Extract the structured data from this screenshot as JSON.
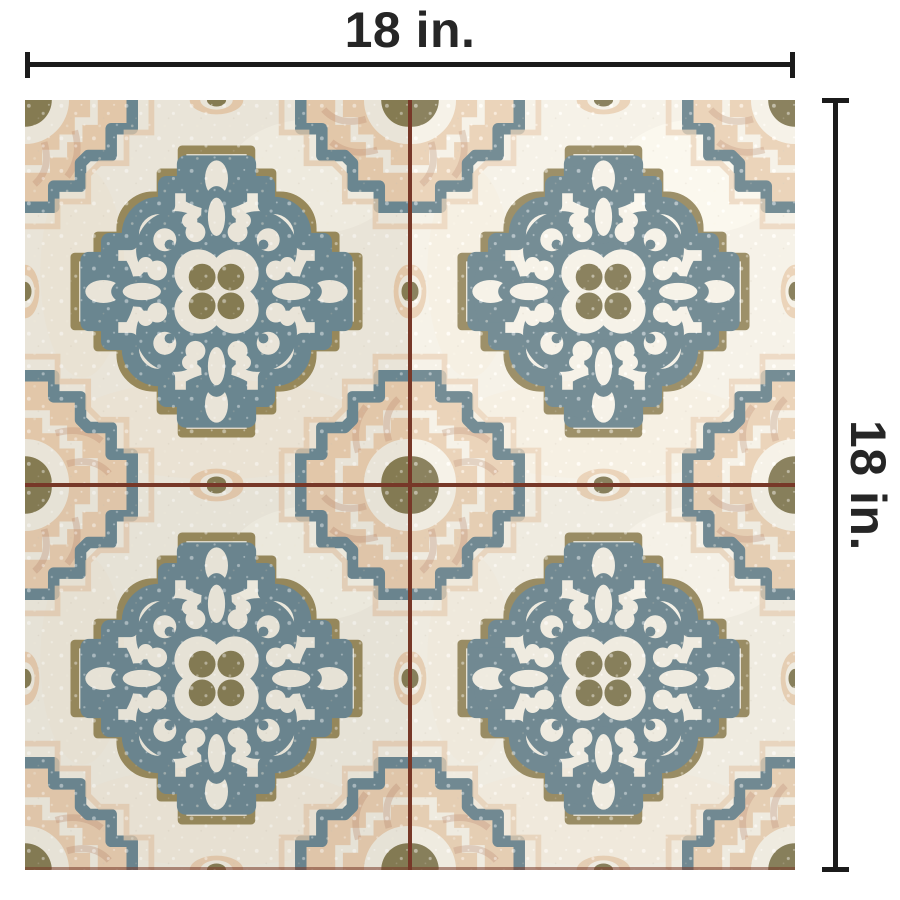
{
  "annotations": {
    "width": {
      "label": "18 in."
    },
    "height": {
      "label": "18 in."
    }
  },
  "style": {
    "line_color": "#1b1b1b",
    "text_color": "#262626",
    "background": "#ffffff"
  },
  "photo": {
    "subject": "patterned ceramic tile",
    "grid": {
      "rows": 2,
      "cols": 2
    },
    "palette": {
      "cream": "#e9e4d8",
      "cream_light": "#f3efe4",
      "peach": "#e2c7a9",
      "peach_light": "#ecd9bd",
      "rust": "#c18f72",
      "teal": "#6a8690",
      "teal_dark": "#5e7c87",
      "olive": "#97885a",
      "olive_dark": "#857b52",
      "grout": "#773828"
    }
  }
}
